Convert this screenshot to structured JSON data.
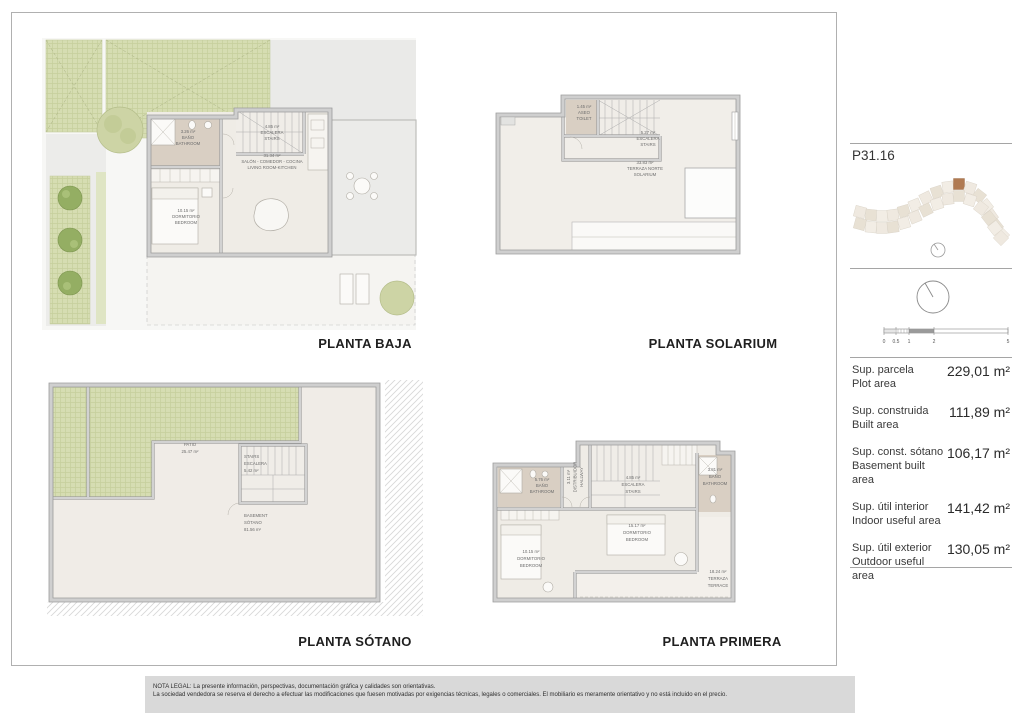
{
  "sheet": {
    "legal_line1": "NOTA LEGAL: La presente información, perspectivas, documentación gráfica y calidades son orientativas.",
    "legal_line2": "La sociedad vendedora se reserva el derecho a efectuar las modificaciones que fuesen motivadas por exigencias técnicas, legales o comerciales. El mobiliario es meramente orientativo y no está incluido en el precio."
  },
  "plans": {
    "baja": {
      "title": "PLANTA BAJA",
      "bano_area": "3.26 m²",
      "bano_es": "BAÑO",
      "bano_en": "BATHROOM",
      "escalera_area": "4.85 m²",
      "escalera_es": "ESCALERA",
      "escalera_en": "STAIRS",
      "salon_area": "31.34 m²",
      "salon_es": "SALÓN - COMEDOR - COCINA",
      "salon_en": "LIVING ROOM-KITCHEN",
      "dormitorio_area": "10.15 m²",
      "dormitorio_es": "DORMITORIO",
      "dormitorio_en": "BEDROOM"
    },
    "solarium": {
      "title": "PLANTA SOLARIUM",
      "aseo_area": "1.45 m²",
      "aseo_es": "ASEO",
      "aseo_en": "TOILET",
      "escalera_area": "5.27 m²",
      "escalera_es": "ESCALERA",
      "escalera_en": "STAIRS",
      "terraza_area": "33.83 m²",
      "terraza_es": "TERRAZA NORTE",
      "terraza_en": "SOLARIUM"
    },
    "sotano": {
      "title": "PLANTA SÓTANO",
      "patio_es": "PATIO",
      "patio_area": "25.47 m²",
      "stairs_l1": "STAIRS",
      "stairs_l2": "ESCALERA",
      "stairs_area": "5.42 m²",
      "basement_l1": "BASEMENT",
      "basement_l2": "SÓTANO",
      "basement_area": "81.56 m²"
    },
    "primera": {
      "title": "PLANTA PRIMERA",
      "bano1_area": "5.76 m²",
      "bano1_es": "BAÑO",
      "bano1_en": "BATHROOM",
      "distribuidor_area": "3.11 m²",
      "distribuidor_es": "DISTRIBUIDOR",
      "distribuidor_en": "HALLWAY",
      "escalera_area": "4.85 m²",
      "escalera_es": "ESCALERA",
      "escalera_en": "STAIRS",
      "bano2_area": "3.81 m²",
      "bano2_es": "BAÑO",
      "bano2_en": "BATHROOM",
      "dorm1_area": "15.17 m²",
      "dorm1_es": "DORMITORIO",
      "dorm1_en": "BEDROOM",
      "dorm2_area": "10.15 m²",
      "dorm2_es": "DORMITORIO",
      "dorm2_en": "BEDROOM",
      "terraza_area": "18.24 m²",
      "terraza_es": "TERRAZA",
      "terraza_en": "TERRACE"
    }
  },
  "sidebar": {
    "unit_code": "P31.16",
    "scale_ticks": [
      "0",
      "0.5",
      "1",
      "2",
      "5"
    ],
    "areas": [
      {
        "label_es": "Sup. parcela",
        "label_en": "Plot area",
        "value": "229,01 m²"
      },
      {
        "label_es": "Sup. construida",
        "label_en": "Built area",
        "value": "111,89 m²"
      },
      {
        "label_es": "Sup. const. sótano",
        "label_en": "Basement built area",
        "value": "106,17 m²"
      },
      {
        "label_es": "Sup. útil interior",
        "label_en": "Indoor useful area",
        "value": "141,42 m²"
      },
      {
        "label_es": "Sup. útil exterior",
        "label_en": "Outdoor useful area",
        "value": "130,05 m²"
      }
    ]
  },
  "colors": {
    "grass": "#d6ddb2",
    "wall": "#cfcfcf",
    "floor": "#efece6",
    "bathroom_floor": "#d9cfc3",
    "highlight_unit": "#b07a52",
    "legal_bg": "#d9d9d9"
  }
}
